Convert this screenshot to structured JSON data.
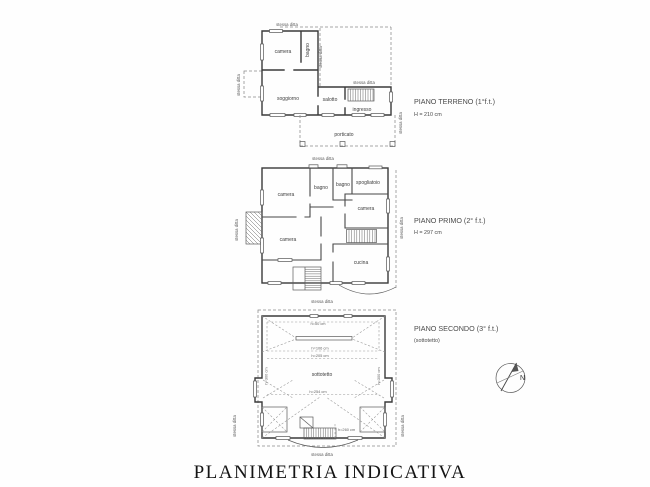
{
  "document": {
    "title": "PLANIMETRIA INDICATIVA"
  },
  "labels": {
    "boundary": "stessa ditta"
  },
  "floors": {
    "terreno": {
      "title": "PIANO TERRENO (1°f.t.)",
      "height": "H = 210 cm",
      "rooms": {
        "camera": "camera",
        "bagno": "bagno",
        "soggiorno": "soggiorno",
        "salotto": "salotto",
        "ingresso": "ingresso",
        "porticato": "porticato"
      }
    },
    "primo": {
      "title": "PIANO PRIMO (2° f.t.)",
      "height": "H = 297 cm",
      "rooms": {
        "camera_nw": "camera",
        "bagno_a": "bagno",
        "bagno_b": "bagno",
        "spogliatoio": "spogliatoio",
        "camera_e": "camera",
        "camera_sw": "camera",
        "cucina": "cucina"
      }
    },
    "secondo": {
      "title": "PIANO SECONDO (3° f.t.)",
      "subtitle": "(sottotetto)",
      "rooms": {
        "sottotetto": "sottotetto"
      },
      "dimensions": {
        "h50": "h=50 cm",
        "h106": "h=106 cm",
        "h205": "h=205 cm",
        "h254": "h=254 cm",
        "h260": "h=260 cm",
        "h300": "h=300 cm"
      }
    }
  },
  "compass": {
    "north": "N"
  }
}
